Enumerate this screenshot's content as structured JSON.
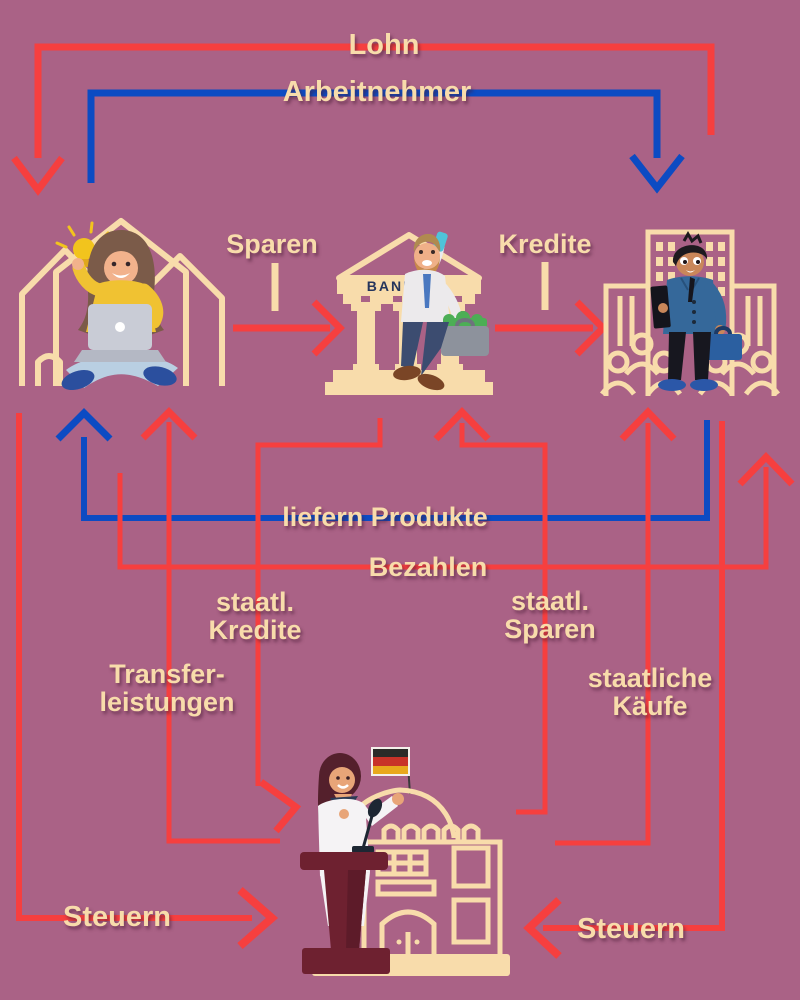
{
  "colors": {
    "bg": "#aa6286",
    "red": "#f63f3f",
    "blue": "#0c4bc3",
    "cream": "#f8dcab"
  },
  "labels": {
    "lohn": "Lohn",
    "arbeitnehmer": "Arbeitnehmer",
    "sparen": "Sparen",
    "kredite": "Kredite",
    "liefern_produkte": "liefern Produkte",
    "bezahlen": "Bezahlen",
    "staatl_kredite": {
      "line1": "staatl.",
      "line2": "Kredite"
    },
    "staatl_sparen": {
      "line1": "staatl.",
      "line2": "Sparen"
    },
    "transferleistungen": {
      "line1": "Transfer-",
      "line2": "leistungen"
    },
    "staatliche_kaeufe": {
      "line1": "staatliche",
      "line2": "Käufe"
    },
    "steuern_left": "Steuern",
    "steuern_right": "Steuern",
    "bank_sign": "BANK"
  },
  "entities": [
    {
      "id": "households",
      "icon": "household-illustration",
      "description": "person with laptop sitting in front of house outlines"
    },
    {
      "id": "bank",
      "icon": "bank-illustration",
      "description": "man with phone and money briefcase in front of bank with BANK pediment"
    },
    {
      "id": "companies",
      "icon": "company-illustration",
      "description": "businessman with briefcase in front of office buildings and crowd"
    },
    {
      "id": "government",
      "icon": "government-illustration",
      "description": "woman speaking at podium in front of capitol building with German flag"
    }
  ],
  "flows": [
    {
      "label": "Lohn",
      "color": "red",
      "from": "companies",
      "to": "households"
    },
    {
      "label": "Arbeitnehmer",
      "color": "blue",
      "from": "households",
      "to": "companies"
    },
    {
      "label": "Sparen",
      "color": "red",
      "from": "households",
      "to": "bank"
    },
    {
      "label": "Kredite",
      "color": "red",
      "from": "bank",
      "to": "companies"
    },
    {
      "label": "liefern Produkte",
      "color": "blue",
      "from": "companies",
      "to": "households"
    },
    {
      "label": "Bezahlen",
      "color": "red",
      "from": "households",
      "to": "companies"
    },
    {
      "label": "staatl. Kredite",
      "color": "red",
      "from": "bank",
      "to": "government"
    },
    {
      "label": "staatl. Sparen",
      "color": "red",
      "from": "government",
      "to": "bank"
    },
    {
      "label": "Transferleistungen",
      "color": "red",
      "from": "government",
      "to": "households"
    },
    {
      "label": "staatliche Käufe",
      "color": "red",
      "from": "government",
      "to": "companies"
    },
    {
      "label": "Steuern",
      "color": "red",
      "from": "households",
      "to": "government"
    },
    {
      "label": "Steuern",
      "color": "red",
      "from": "companies",
      "to": "government"
    }
  ]
}
